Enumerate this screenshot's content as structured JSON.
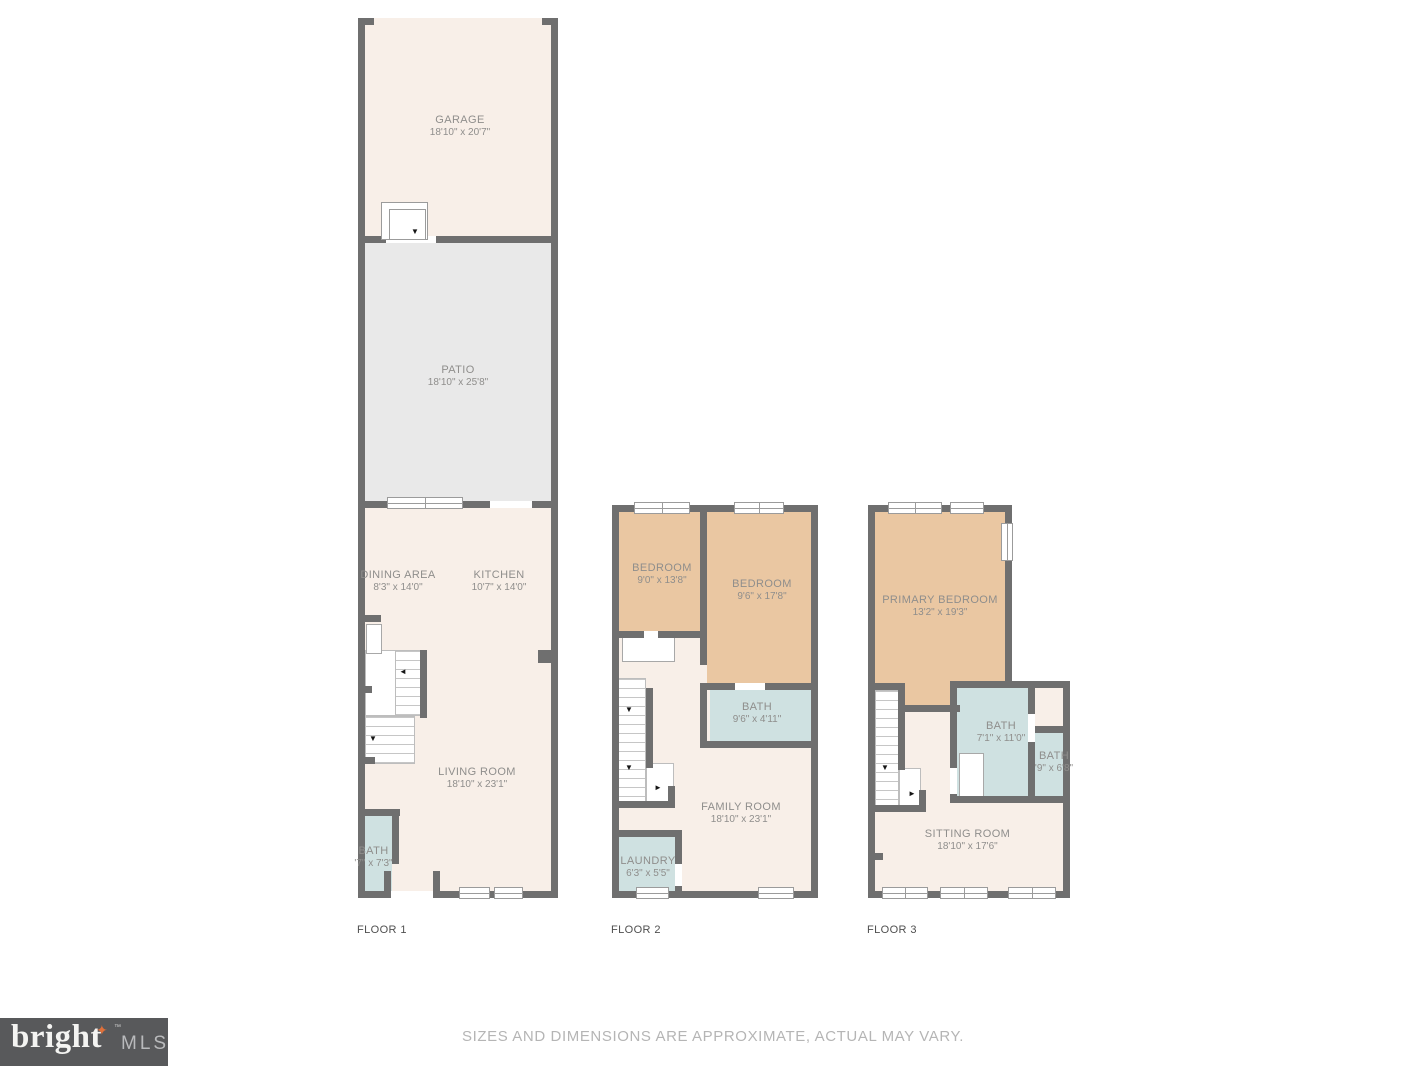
{
  "colors": {
    "wall": "#6f6f6f",
    "floor": "#f8efe8",
    "patio": "#e9e9e9",
    "bedroom": "#eac7a2",
    "bath": "#cfe1e1",
    "room_label": "#8f8e8c",
    "floor_label": "#4f4f4f",
    "disclaimer": "#b5b5b5",
    "logo_bg": "#58595b",
    "logo_text": "#f4f4f2",
    "logo_mls": "#b9babc",
    "logo_star": "#e0703a"
  },
  "floors": [
    {
      "label": "FLOOR 1",
      "rooms": {
        "garage": {
          "name": "GARAGE",
          "dims": "18'10\" x 20'7\""
        },
        "patio": {
          "name": "PATIO",
          "dims": "18'10\" x 25'8\""
        },
        "dining": {
          "name": "DINING AREA",
          "dims": "8'3\" x 14'0\""
        },
        "kitchen": {
          "name": "KITCHEN",
          "dims": "10'7\" x 14'0\""
        },
        "living": {
          "name": "LIVING ROOM",
          "dims": "18'10\" x 23'1\""
        },
        "bath": {
          "name": "BATH",
          "dims": "'7\" x 7'3\""
        }
      }
    },
    {
      "label": "FLOOR 2",
      "rooms": {
        "bedroom1": {
          "name": "BEDROOM",
          "dims": "9'0\" x 13'8\""
        },
        "bedroom2": {
          "name": "BEDROOM",
          "dims": "9'6\" x 17'8\""
        },
        "bath": {
          "name": "BATH",
          "dims": "9'6\" x 4'11\""
        },
        "family": {
          "name": "FAMILY ROOM",
          "dims": "18'10\" x 23'1\""
        },
        "laundry": {
          "name": "LAUNDRY",
          "dims": "6'3\" x 5'5\""
        }
      }
    },
    {
      "label": "FLOOR 3",
      "rooms": {
        "primary": {
          "name": "PRIMARY BEDROOM",
          "dims": "13'2\" x 19'3\""
        },
        "bath1": {
          "name": "BATH",
          "dims": "7'1\" x 11'0\""
        },
        "bath2": {
          "name": "BATH",
          "dims": "'9\" x 6'8\""
        },
        "sitting": {
          "name": "SITTING ROOM",
          "dims": "18'10\" x 17'6\""
        }
      }
    }
  ],
  "footer": {
    "logo": {
      "brand": "bright",
      "tm": "™",
      "suffix": "MLS",
      "star": "✦"
    },
    "disclaimer": "SIZES AND DIMENSIONS ARE APPROXIMATE, ACTUAL MAY VARY."
  }
}
